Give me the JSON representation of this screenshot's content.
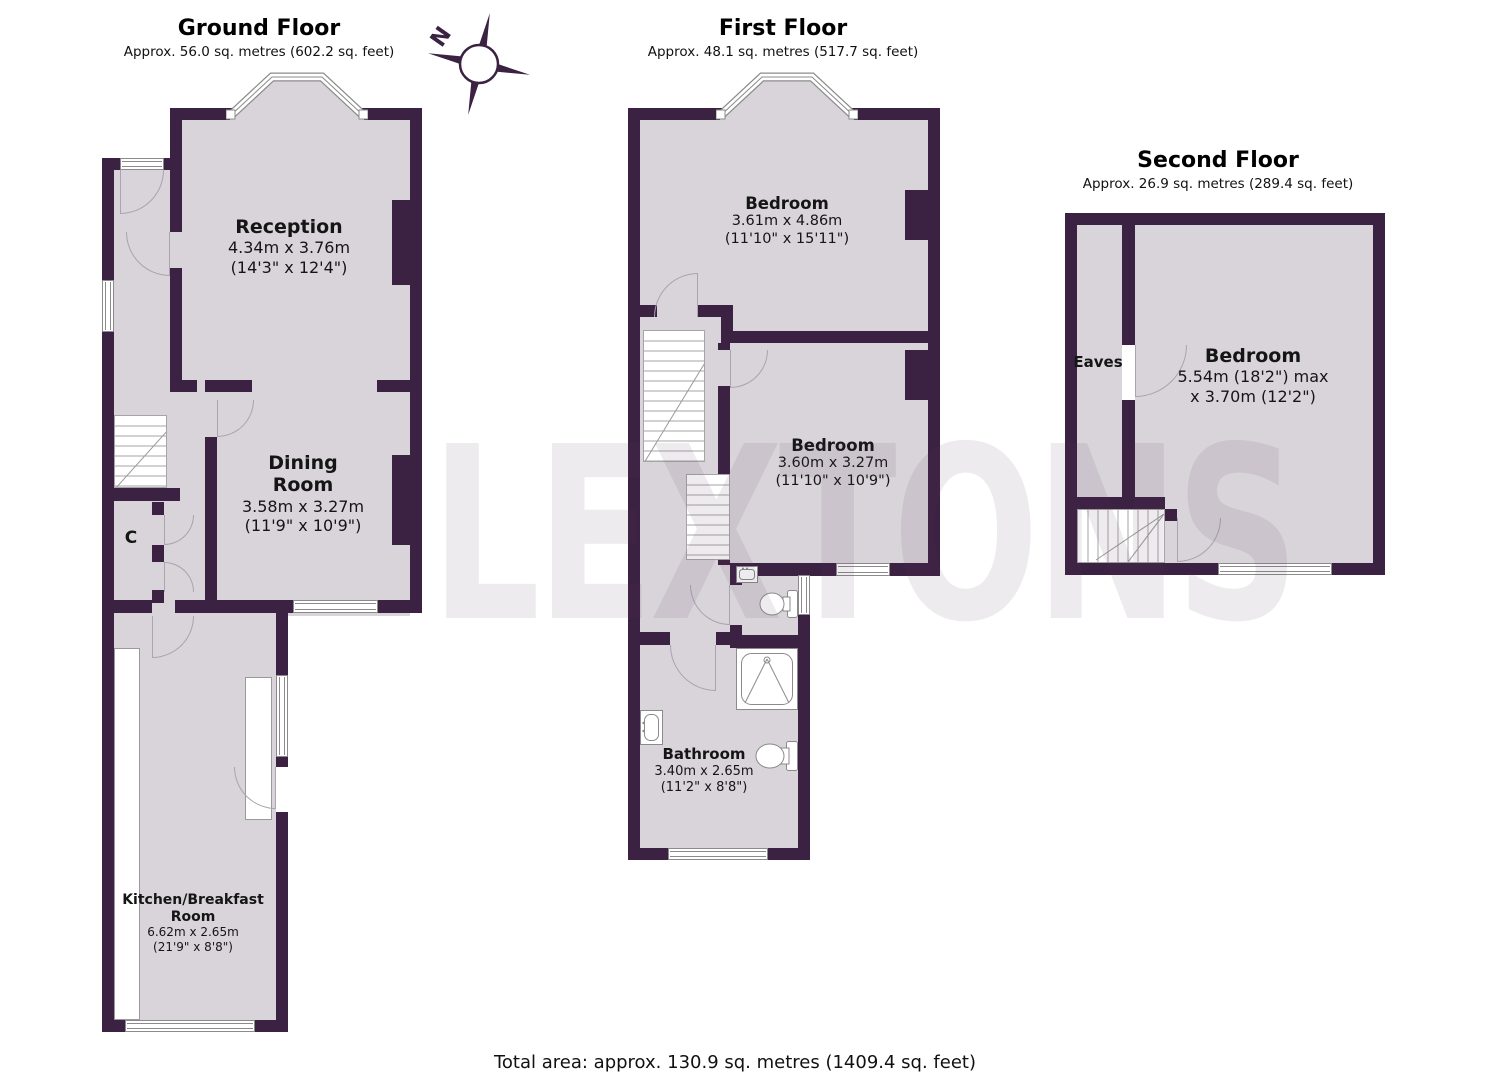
{
  "watermark": "LEXTONS",
  "compass": {
    "north_label": "N"
  },
  "colors": {
    "wall": "#3b2142",
    "floor": "#d8d4d9"
  },
  "footer": {
    "total_area": "Total area: approx. 130.9 sq. metres (1409.4 sq. feet)"
  },
  "floors": {
    "ground": {
      "title": "Ground Floor",
      "area": "Approx. 56.0 sq. metres (602.2 sq. feet)",
      "rooms": {
        "reception": {
          "name": "Reception",
          "metric": "4.34m x 3.76m",
          "imperial": "(14'3\" x 12'4\")"
        },
        "dining": {
          "line1": "Dining",
          "line2": "Room",
          "metric": "3.58m x 3.27m",
          "imperial": "(11'9\" x 10'9\")"
        },
        "kitchen": {
          "line1": "Kitchen/Breakfast",
          "line2": "Room",
          "metric": "6.62m x 2.65m",
          "imperial": "(21'9\" x 8'8\")"
        },
        "closet": {
          "name": "C"
        }
      }
    },
    "first": {
      "title": "First Floor",
      "area": "Approx. 48.1 sq. metres (517.7 sq. feet)",
      "rooms": {
        "bedroom1": {
          "name": "Bedroom",
          "metric": "3.61m x 4.86m",
          "imperial": "(11'10\" x 15'11\")"
        },
        "bedroom2": {
          "name": "Bedroom",
          "metric": "3.60m x 3.27m",
          "imperial": "(11'10\" x 10'9\")"
        },
        "bathroom": {
          "name": "Bathroom",
          "metric": "3.40m x 2.65m",
          "imperial": "(11'2\" x 8'8\")"
        }
      }
    },
    "second": {
      "title": "Second Floor",
      "area": "Approx. 26.9 sq. metres (289.4 sq. feet)",
      "rooms": {
        "bedroom": {
          "name": "Bedroom",
          "metric": "5.54m (18'2\") max",
          "imperial": "x 3.70m (12'2\")"
        },
        "eaves": {
          "name": "Eaves"
        }
      }
    }
  }
}
